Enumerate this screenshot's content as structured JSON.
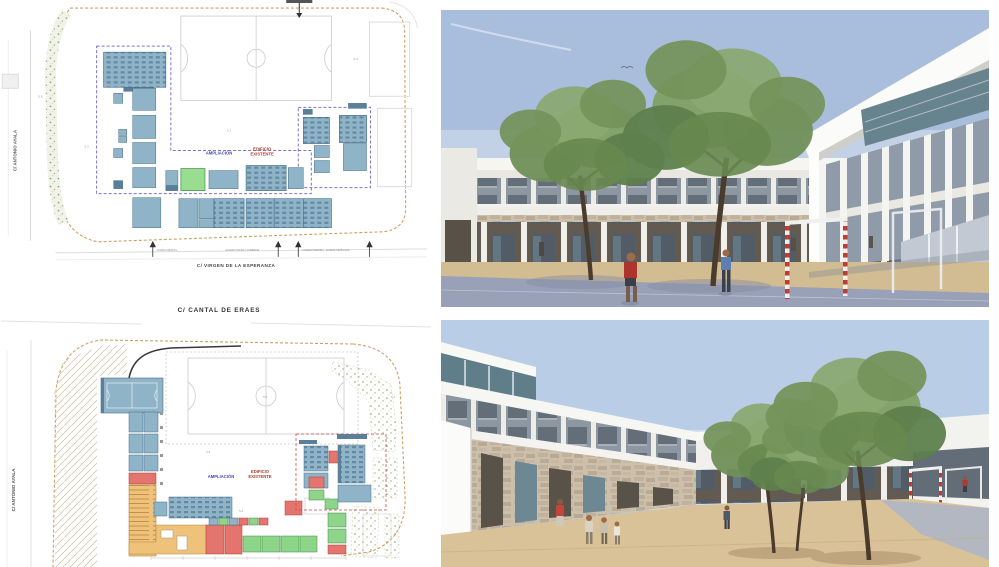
{
  "board": {
    "background": "#ffffff",
    "description_labels_visible": true
  },
  "plans": {
    "upper": {
      "street_left": "C/ ANTONIO AYALA",
      "street_bottom": "C/ VIRGEN DE LA ESPERANZA",
      "legend": {
        "new": "AMPLIACIÓN",
        "existing_line1": "EDIFICIO",
        "existing_line2": "EXISTENTE"
      },
      "access": [
        "ACCESO INFANTIL",
        "ACCESO COCINA Y COMEDOR",
        "ACCESO PRIMARIA",
        "ACCESO VEHÍCULOS"
      ],
      "area_marks": [
        "5.8",
        "5.3",
        "5.1",
        "6.4"
      ],
      "colors": {
        "room_blue": "#8fb3c7",
        "room_green": "#98dd90",
        "boundary_new": "#7b74c9",
        "site_edge": "#c9a265"
      }
    },
    "lower": {
      "street_top": "C/ CANTAL DE ERAES",
      "street_left": "C/ ANTONIO AYALA",
      "legend": {
        "new": "AMPLIACIÓN",
        "existing_line1": "EDIFICIO",
        "existing_line2": "EXISTENTE"
      },
      "area_marks": [
        "5.3",
        "5.8",
        "6.4",
        "5.4"
      ],
      "colors": {
        "room_blue": "#8fb3c7",
        "room_green": "#8ed489",
        "room_red": "#e4756e",
        "room_orange": "#efc27b",
        "boundary_existing": "#c0504d"
      }
    }
  },
  "renderings": {
    "upper": {
      "colors": {
        "sky": "#a9bedd",
        "court": "#98a1b7",
        "sand": "#d2bc92",
        "goal": "#c23b2e",
        "foliage": "#74945c"
      }
    },
    "lower": {
      "colors": {
        "sky": "#b9cde6",
        "sand": "#d9c198",
        "pavement": "#b2b7c2",
        "goal": "#c23b2e",
        "foliage": "#74945c"
      }
    }
  }
}
